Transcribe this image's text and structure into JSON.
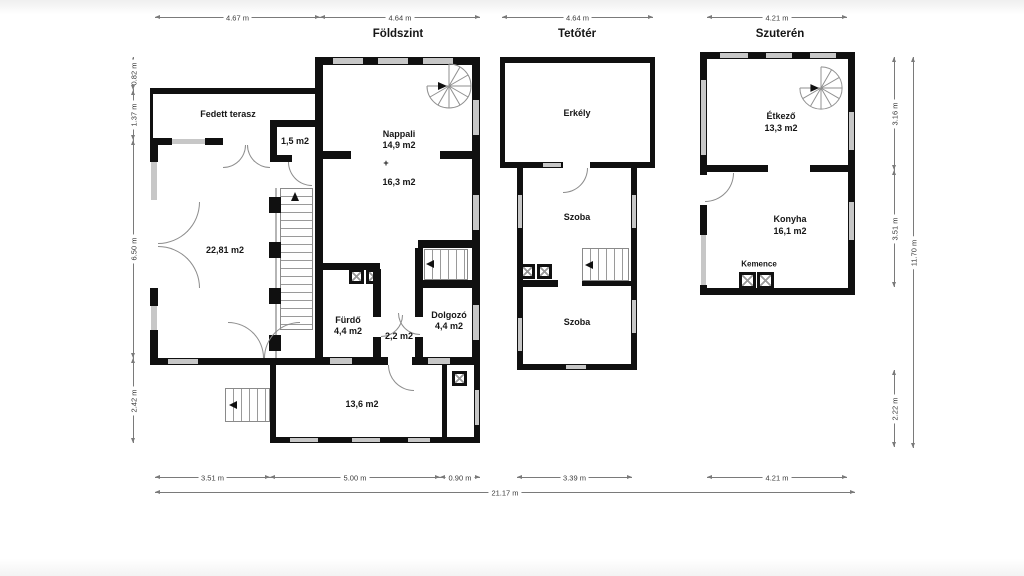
{
  "plans": {
    "foldszint": {
      "title": "Földszint",
      "rooms": {
        "fedett_terasz": "Fedett terasz",
        "kamra_area": "1,5 m2",
        "nappali_name": "Nappali",
        "nappali_area1": "14,9 m2",
        "plus": "+",
        "nappali_area2": "16,3 m2",
        "nagyszoba_area": "22,81 m2",
        "furdo_name": "Fürdő",
        "furdo_area": "4,4 m2",
        "kozlekedo_area": "2,2 m2",
        "dolgozo_name": "Dolgozó",
        "dolgozo_area": "4,4 m2",
        "also_area": "13,6 m2"
      }
    },
    "tetoter": {
      "title": "Tetőtér",
      "rooms": {
        "erkely": "Erkély",
        "szoba_felso": "Szoba",
        "szoba_also": "Szoba"
      }
    },
    "szuteren": {
      "title": "Szuterén",
      "rooms": {
        "etkezo_name": "Étkező",
        "etkezo_area": "13,3 m2",
        "konyha_name": "Konyha",
        "konyha_area": "16,1 m2",
        "kemence": "Kemence"
      }
    }
  },
  "dims": {
    "top": [
      "4.67 m",
      "4.64 m",
      "4.64 m",
      "4.21 m"
    ],
    "left": [
      "0.82 m",
      "1.37 m",
      "6.50 m",
      "2.42 m"
    ],
    "right": [
      "3.16 m",
      "3.51 m",
      "2.22 m",
      "11.70 m"
    ],
    "bottom": [
      "3.51 m",
      "5.00 m",
      "0.90 m",
      "3.39 m",
      "4.21 m",
      "21.17 m"
    ]
  },
  "colors": {
    "wall": "#101010",
    "window": "#c7c7c7",
    "dimension": "#7a7a7a",
    "background": "#ffffff"
  }
}
